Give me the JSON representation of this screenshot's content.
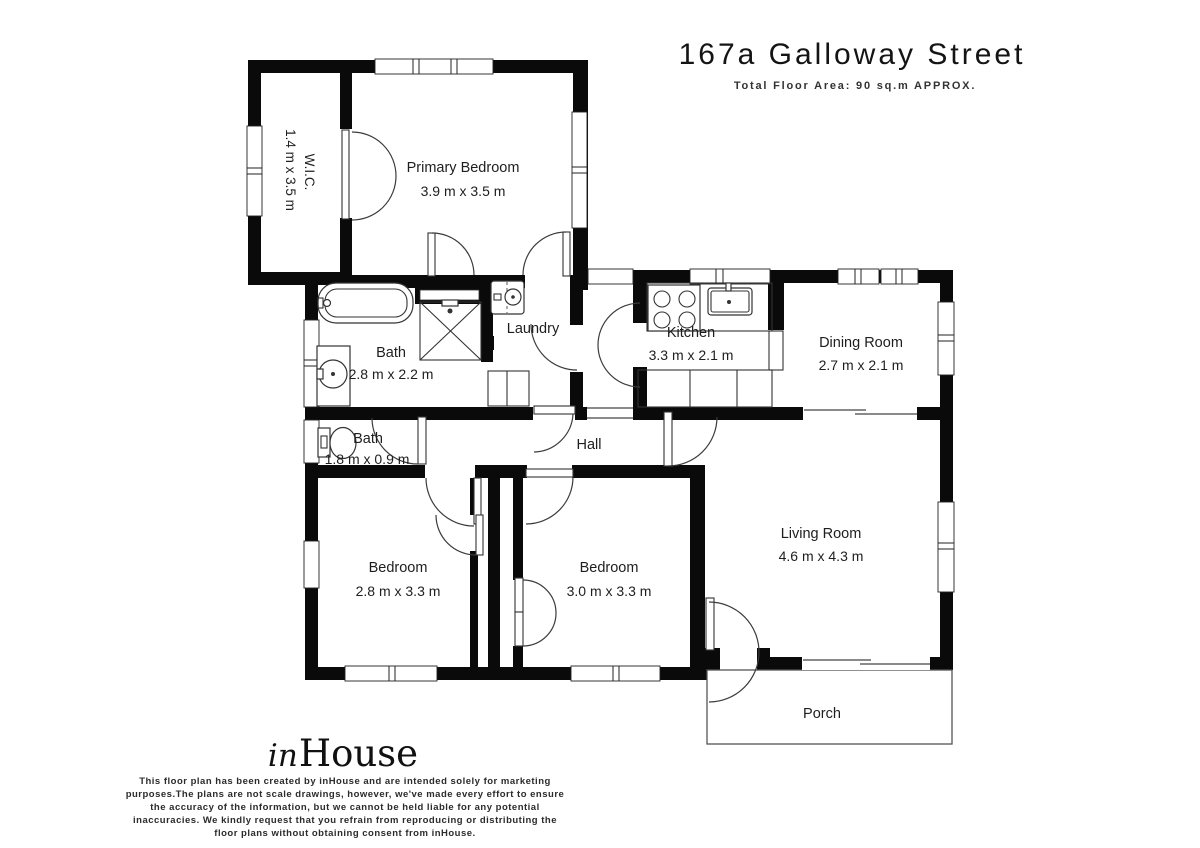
{
  "header": {
    "title": "167a Galloway Street",
    "subtitle": "Total Floor Area: 90 sq.m APPROX."
  },
  "rooms": {
    "wic": {
      "name": "W.I.C.",
      "dims": "1.4 m x 3.5 m"
    },
    "primary_bedroom": {
      "name": "Primary Bedroom",
      "dims": "3.9 m x 3.5 m"
    },
    "bath": {
      "name": "Bath",
      "dims": "2.8 m x 2.2 m"
    },
    "laundry": {
      "name": "Laundry"
    },
    "kitchen": {
      "name": "Kitchen",
      "dims": "3.3 m x 2.1 m"
    },
    "dining": {
      "name": "Dining Room",
      "dims": "2.7 m x 2.1 m"
    },
    "bath_small": {
      "name": "Bath",
      "dims": "1.8 m x 0.9 m"
    },
    "hall": {
      "name": "Hall"
    },
    "bedroom_left": {
      "name": "Bedroom",
      "dims": "2.8 m x 3.3 m"
    },
    "bedroom_right": {
      "name": "Bedroom",
      "dims": "3.0 m x 3.3 m"
    },
    "living": {
      "name": "Living Room",
      "dims": "4.6 m x 4.3 m"
    },
    "porch": {
      "name": "Porch"
    }
  },
  "branding": {
    "logo_script": "in",
    "logo_serif": "House"
  },
  "disclaimer": {
    "lines": [
      "This floor plan has been created by inHouse and are intended solely for marketing",
      "purposes.The plans are not scale drawings, however, we've made every effort to ensure",
      "the accuracy of the information, but we cannot be held liable for any potential",
      "inaccuracies. We kindly request that you refrain from reproducing or distributing the",
      "floor plans without obtaining consent from inHouse."
    ]
  },
  "colors": {
    "wall": "#0a0a0a",
    "text": "#1e1e1e",
    "line": "#3c3c3c"
  }
}
